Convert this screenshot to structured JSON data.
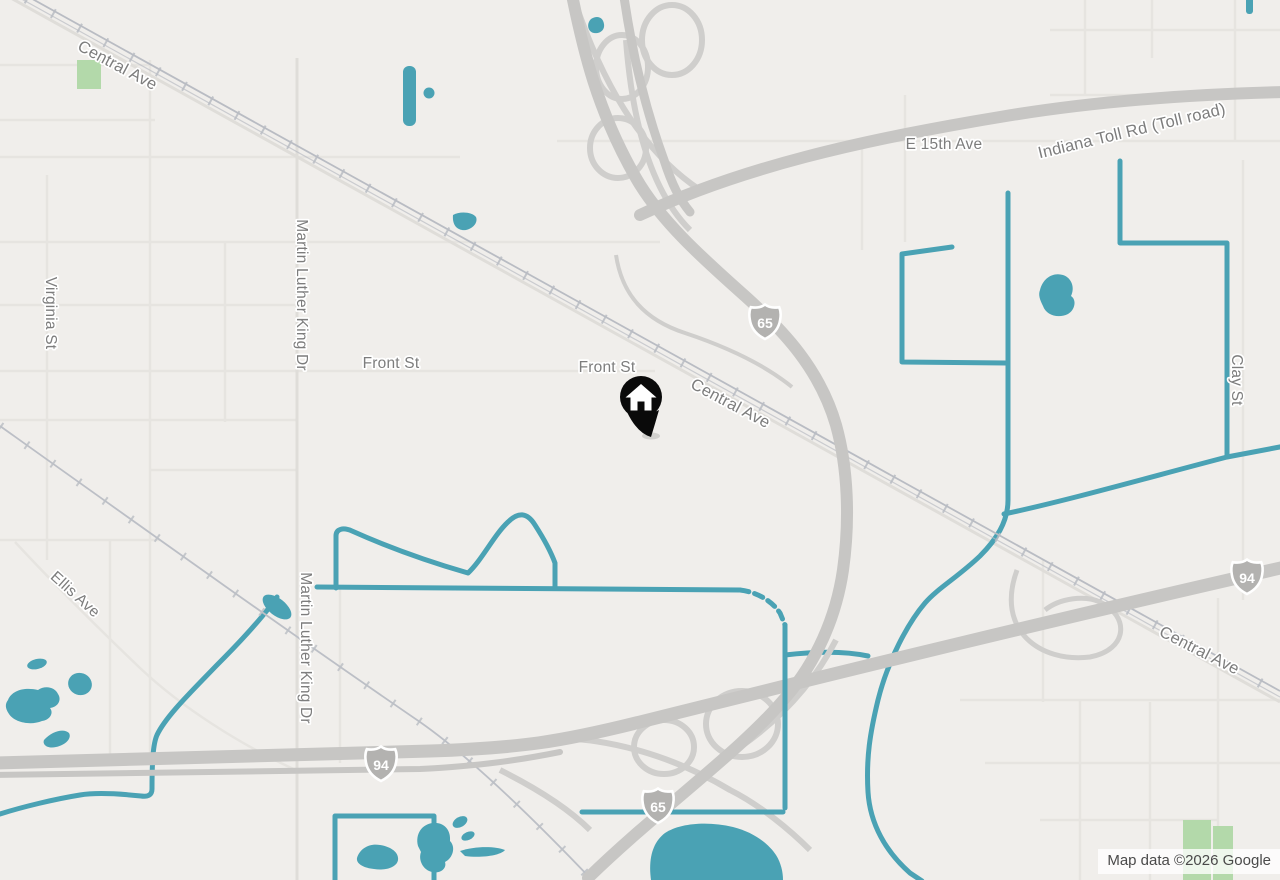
{
  "map": {
    "provider_logo_text": "Google",
    "attribution_text": "Map data ©2026 Google",
    "labels": {
      "central_ave_1": "Central Ave",
      "central_ave_2": "Central Ave",
      "central_ave_3": "Central Ave",
      "front_st_1": "Front St",
      "front_st_2": "Front St",
      "e_15th_ave": "E 15th Ave",
      "indiana_toll_rd": "Indiana Toll Rd (Toll road)",
      "virginia_st": "Virginia St",
      "mlk_dr_1": "Martin Luther King Dr",
      "mlk_dr_2": "Martin Luther King Dr",
      "ellis_ave": "Ellis Ave",
      "clay_st": "Clay St"
    },
    "shields": {
      "i65_north": "65",
      "i65_south": "65",
      "i94_west": "94",
      "i94_east": "94"
    },
    "marker": {
      "type": "home-location-pin"
    },
    "colors": {
      "background": "#f0eeeb",
      "water": "#4aa2b4",
      "highway": "#c7c6c4",
      "ramp": "#cfcecc",
      "railroad": "#b9bcc3",
      "minor_road": "#e6e4e0",
      "park_green": "#b3d9aa",
      "label_text": "#7d7d7d",
      "shield_fill": "#b3b2b0",
      "marker_black": "#0a0a0a",
      "attribution_text": "#4a4a4a"
    }
  }
}
